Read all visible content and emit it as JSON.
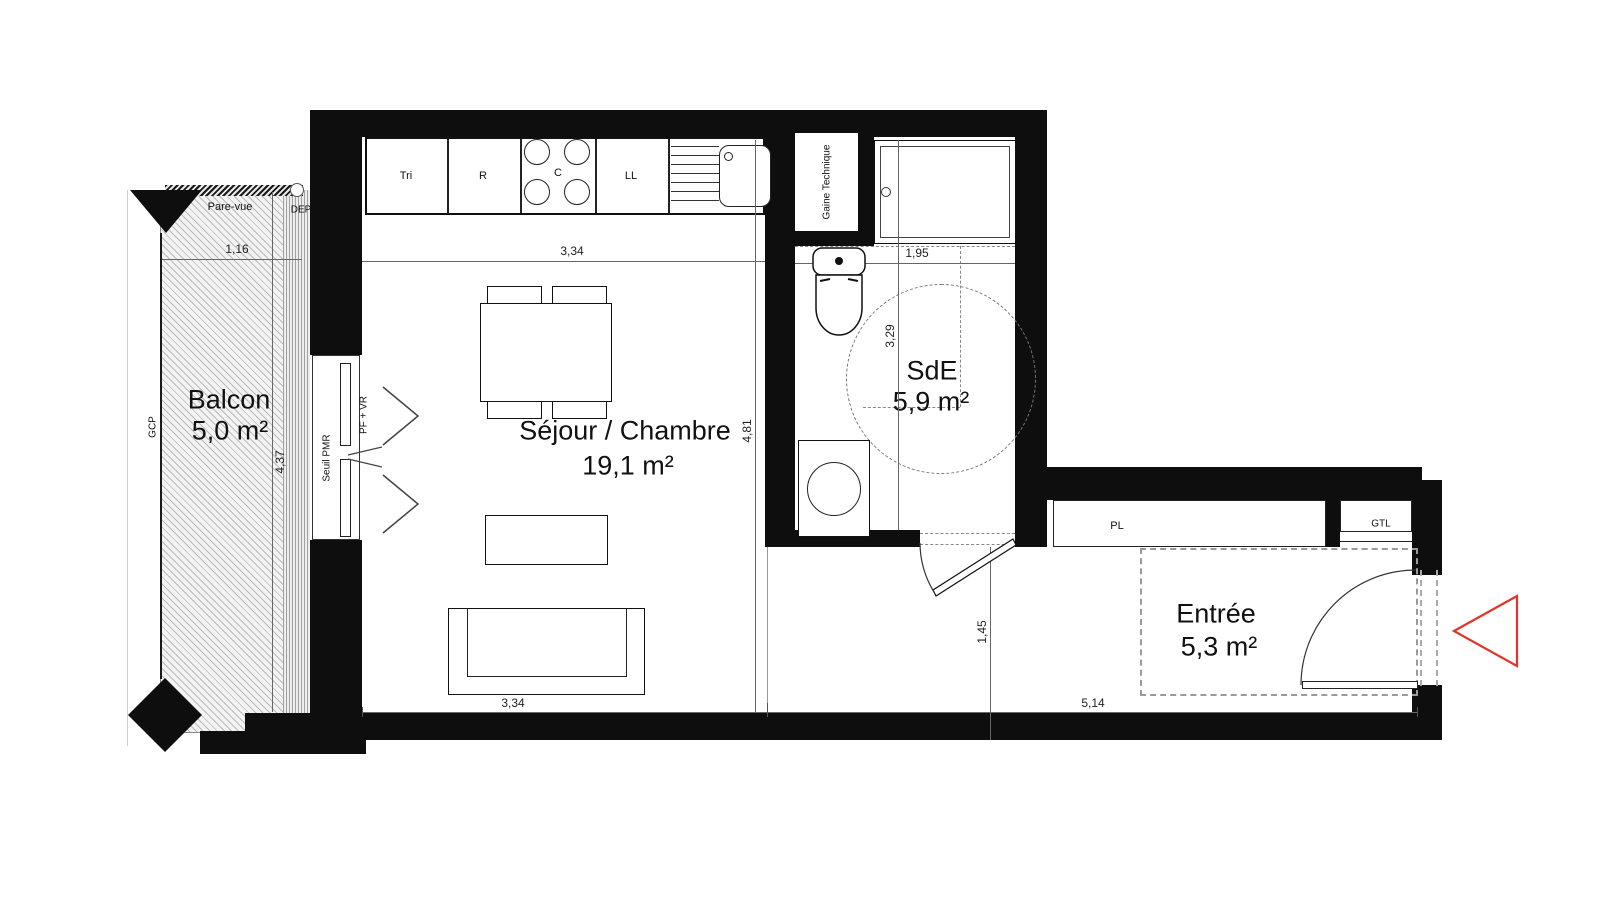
{
  "rooms": {
    "balcony": {
      "name": "Balcon",
      "area": "5,0 m²"
    },
    "living": {
      "name": "Séjour / Chambre",
      "area": "19,1 m²"
    },
    "shower_room": {
      "name": "SdE",
      "area": "5,9 m²"
    },
    "entrance": {
      "name": "Entrée",
      "area": "5,3 m²"
    }
  },
  "kitchen_units": {
    "tri": "Tri",
    "fridge": "R",
    "cooktop": "C",
    "washer": "LL"
  },
  "labels": {
    "pare_vue": "Pare-vue",
    "dep": "DEP",
    "gcp": "GCP",
    "seuil_pmr": "Seuil PMR",
    "pf_vr": "PF + VR",
    "gaine_technique": "Gaine Technique",
    "closet": "PL",
    "gtl": "GTL"
  },
  "dimensions": {
    "balcony_width": "1,16",
    "balcony_depth": "4,37",
    "living_width_top": "3,34",
    "living_width_bottom": "3,34",
    "living_depth": "4,81",
    "sde_width": "1,95",
    "sde_depth": "3,29",
    "hall_depth": "1,45",
    "entrance_width": "5,14"
  },
  "colors": {
    "wall": "#0e0e0e",
    "entrance_arrow": "#df352b"
  }
}
